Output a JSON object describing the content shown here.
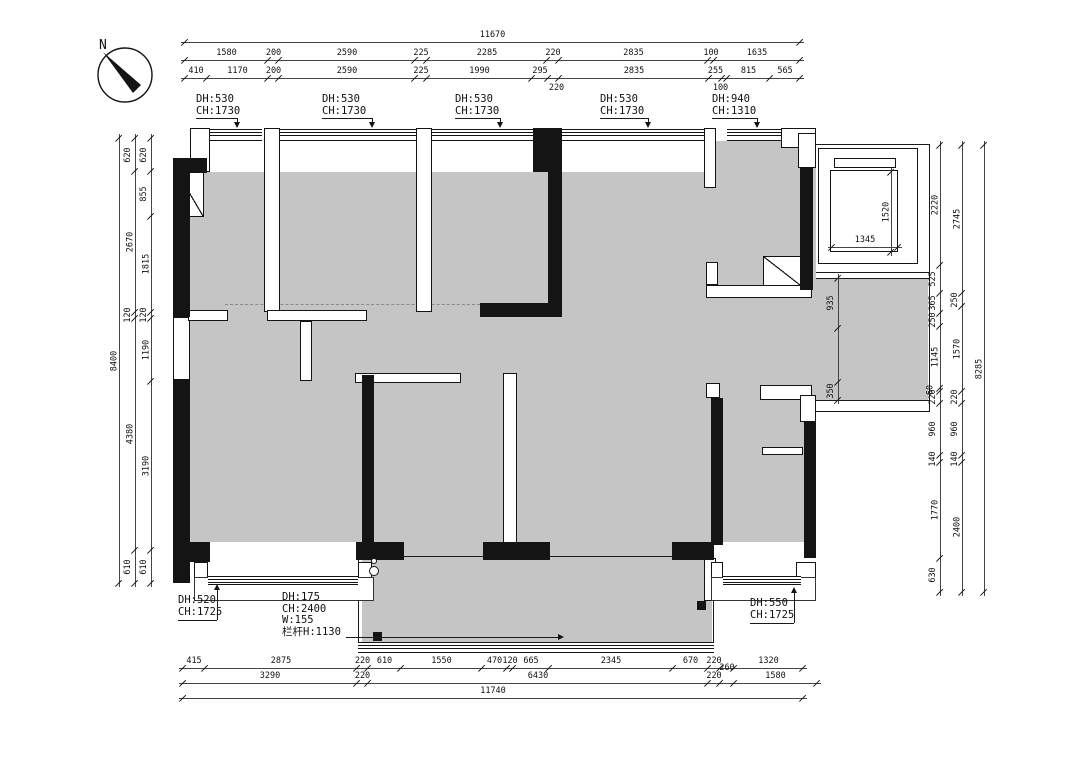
{
  "north_label": "N",
  "window_top_labels": [
    {
      "dh": "DH:530",
      "ch": "CH:1730"
    },
    {
      "dh": "DH:530",
      "ch": "CH:1730"
    },
    {
      "dh": "DH:530",
      "ch": "CH:1730"
    },
    {
      "dh": "DH:530",
      "ch": "CH:1730"
    },
    {
      "dh": "DH:940",
      "ch": "CH:1310"
    }
  ],
  "bottom_left_window_label": {
    "dh": "DH:520",
    "ch": "CH:1725"
  },
  "bottom_right_window_label": {
    "dh": "DH:550",
    "ch": "CH:1725"
  },
  "balcony_label_lines": [
    "DH:175",
    "CH:2400",
    "W:155",
    "栏杆H:1130"
  ],
  "dimensions": {
    "top": {
      "total": "11670",
      "row2": [
        "1580",
        "200",
        "2590",
        "225",
        "2285",
        "220",
        "2835",
        "100",
        "1635"
      ],
      "row3": [
        "410",
        "1170",
        "200",
        "2590",
        "225",
        "1990",
        "295",
        "220",
        "2835",
        "255",
        "100",
        "815",
        "565"
      ]
    },
    "left": {
      "total": "8400",
      "mid": [
        "620",
        "2670",
        "120",
        "4380",
        "610"
      ],
      "inner": [
        "620",
        "855",
        "1815",
        "120",
        "1190",
        "3190",
        "610"
      ]
    },
    "right": {
      "total": "8285",
      "mid": [
        "2745",
        "250",
        "1570",
        "220",
        "960",
        "140",
        "2400"
      ],
      "inner": [
        "2220",
        "525",
        "365",
        "250",
        "1145",
        "60",
        "220",
        "960",
        "140",
        "1770",
        "630"
      ]
    },
    "bottom": {
      "row1": [
        "415",
        "2875",
        "220",
        "610",
        "1550",
        "470",
        "120",
        "665",
        "2345",
        "670",
        "220",
        "",
        "1320"
      ],
      "row2": [
        "3290",
        "220",
        "6430",
        "220",
        "260",
        "1580"
      ],
      "total": "11740"
    },
    "corridor": [
      "935",
      "",
      "350"
    ],
    "elevator": {
      "width": "1345",
      "depth": "1520"
    }
  }
}
